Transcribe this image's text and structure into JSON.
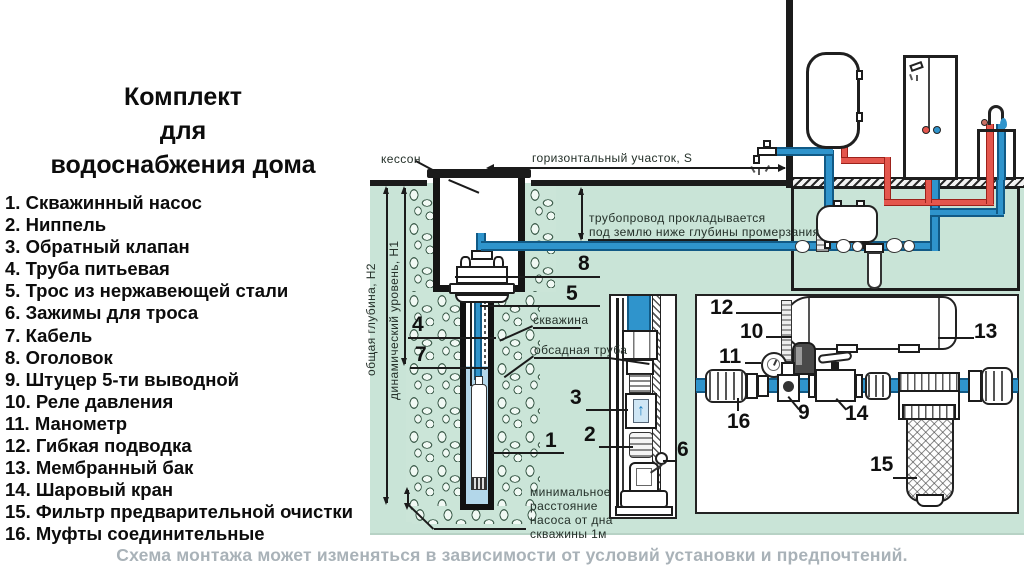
{
  "header": {
    "title_line1": "Комплект",
    "title_line2": "для",
    "title_line3": "водоснабжения дома"
  },
  "parts": {
    "items": [
      {
        "num": "1.",
        "label": "Скважинный насос"
      },
      {
        "num": "2.",
        "label": "Ниппель"
      },
      {
        "num": "3.",
        "label": "Обратный клапан"
      },
      {
        "num": "4.",
        "label": "Труба питьевая"
      },
      {
        "num": "5.",
        "label": "Трос из нержавеющей стали"
      },
      {
        "num": "6.",
        "label": "Зажимы для троса"
      },
      {
        "num": "7.",
        "label": "Кабель"
      },
      {
        "num": "8.",
        "label": "Оголовок"
      },
      {
        "num": "9.",
        "label": "Штуцер 5-ти выводной"
      },
      {
        "num": "10.",
        "label": "Реле давления"
      },
      {
        "num": "11.",
        "label": "Манометр"
      },
      {
        "num": "12.",
        "label": "Гибкая подводка"
      },
      {
        "num": "13.",
        "label": "Мембранный бак"
      },
      {
        "num": "14.",
        "label": "Шаровый кран"
      },
      {
        "num": "15.",
        "label": "Фильтр предварительной очистки"
      },
      {
        "num": "16.",
        "label": "Муфты соединительные"
      }
    ]
  },
  "diagram": {
    "labels": {
      "kesson": "кессон",
      "horizontal_section": "горизонтальный участок, S",
      "pipeline_note_1": "трубопровод прокладывается",
      "pipeline_note_2": "под землю ниже глубины промерзания",
      "total_depth": "общая глубина, Н2",
      "dynamic_level": "динамический уровень, Н1",
      "well": "скважина",
      "casing": "обсадная труба",
      "min_dist_1": "минимальное",
      "min_dist_2": "расстояние",
      "min_dist_3": "насоса от дна",
      "min_dist_4": "скважины 1м"
    },
    "callouts": {
      "c1": "1",
      "c2": "2",
      "c3": "3",
      "c4": "4",
      "c5": "5",
      "c6": "6",
      "c7": "7",
      "c8": "8",
      "c9": "9",
      "c10": "10",
      "c11": "11",
      "c12": "12",
      "c13": "13",
      "c14": "14",
      "c15": "15",
      "c16": "16"
    },
    "icons": {
      "check_valve_arrow": "↑"
    }
  },
  "footer": {
    "note": "Схема монтажа может изменяться в зависимости от условий установки и предпочтений."
  },
  "colors": {
    "ground_green": "#c9e4d7",
    "pipe_blue": "#2f94cc",
    "pipe_blue_dark": "#115a86",
    "pipe_red": "#e4564d",
    "water_blue": "#b3d7ea",
    "caption_gray": "#a9b2b8"
  }
}
